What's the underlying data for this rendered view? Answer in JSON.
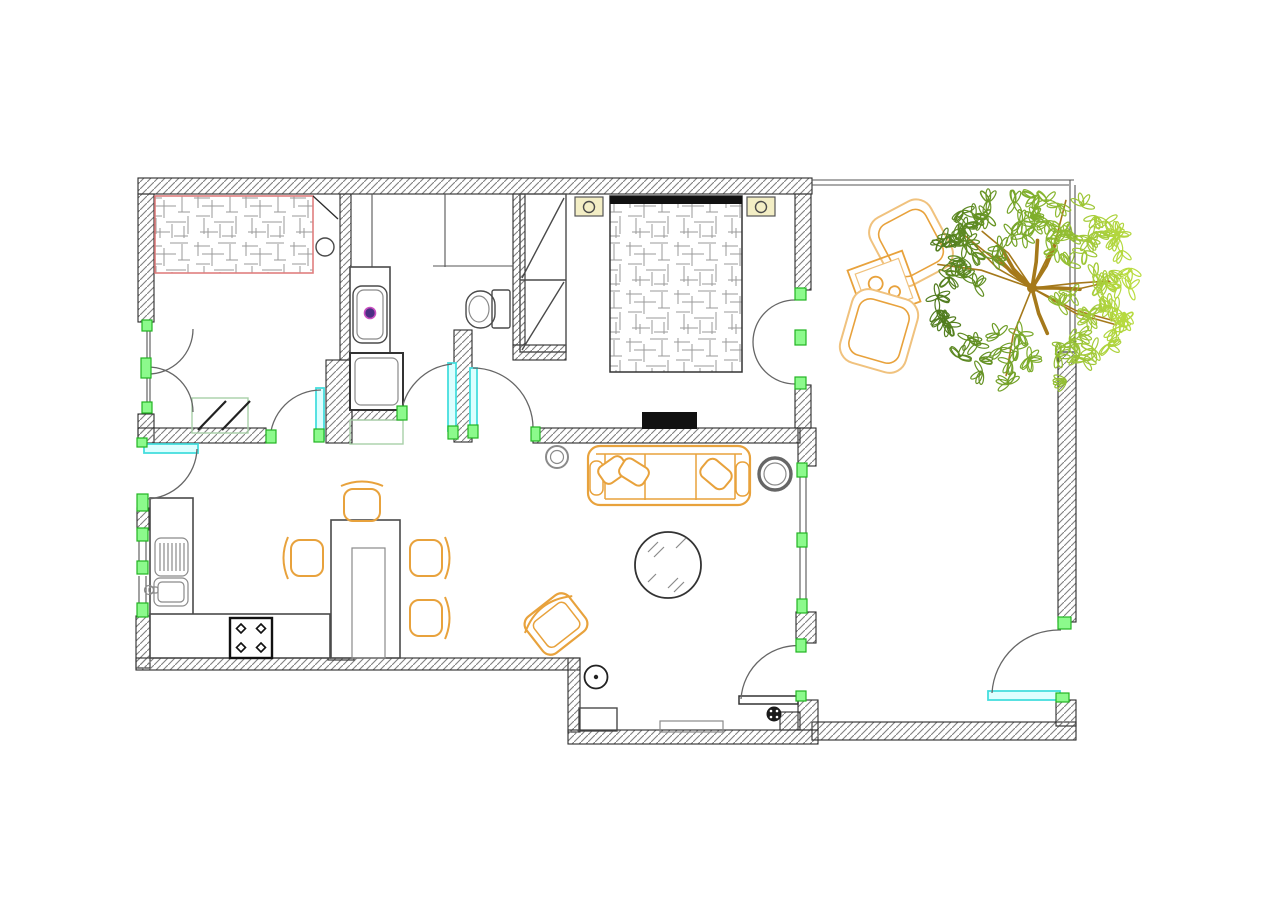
{
  "document": {
    "type": "architectural-floor-plan",
    "title": "Apartment floor plan with terrace and garden tree",
    "background": "#ffffff",
    "visible_text": ""
  },
  "colors": {
    "wall_stroke": "#2b2b2b",
    "wall_hatch": "#808080",
    "furniture": "#4a4a4a",
    "furniture_gray": "#8a8a8a",
    "black": "#111111",
    "orange": "#E8A23C",
    "orange_light": "#F0C27E",
    "marker_green_fill": "#8CFA8C",
    "marker_green_stroke": "#22B422",
    "door_cyan_stroke": "#45DEDE",
    "door_cyan_fill": "#DCFFFF",
    "bed_outline_red": "#E07F7F",
    "bed_hatch": "#9a9a9a",
    "fixture_yellow": "#F3EEC5",
    "drain_purple": "#4B2E83",
    "drain_magenta": "#C94FC0",
    "mat_green": "#A8D0A8",
    "tree_branch": "#A5791B",
    "leaf_dark": "#4F7A1E",
    "leaf_mid": "#7FAE2C",
    "leaf_light": "#B9DC40"
  },
  "rooms": [
    {
      "name": "second-bedroom",
      "position": "top-left",
      "furniture": [
        "double-bed-red-outline",
        "round-stool",
        "floor-mat",
        "double-entry-doors"
      ]
    },
    {
      "name": "laundry-niche",
      "position": "top-center-left",
      "furniture": [
        "washbasin-with-drain",
        "washing-machine",
        "shelf-mat",
        "service-shaft"
      ]
    },
    {
      "name": "bathroom",
      "position": "top-center",
      "furniture": [
        "shower-partition",
        "toilet"
      ]
    },
    {
      "name": "master-bedroom",
      "position": "top-right-of-center",
      "furniture": [
        "double-bed",
        "headboard",
        "nightstand-left",
        "nightstand-right",
        "built-in-wardrobe",
        "tv",
        "french-doors-to-terrace"
      ]
    },
    {
      "name": "kitchen",
      "position": "bottom-left",
      "furniture": [
        "counter-l-shape",
        "sink-basin",
        "drainboard",
        "faucet",
        "cooktop-4-burner"
      ]
    },
    {
      "name": "dining-area",
      "position": "bottom-center-left",
      "furniture": [
        "dining-table",
        "chair-north",
        "chair-west",
        "chair-east-upper",
        "chair-east-lower"
      ]
    },
    {
      "name": "living-room",
      "position": "bottom-center",
      "furniture": [
        "sofa-three-seat",
        "throw-pillows",
        "planter-small",
        "planter-large",
        "round-glass-coffee-table",
        "armchair",
        "floor-lamp",
        "glazed-wall"
      ]
    },
    {
      "name": "entry-hall",
      "position": "bottom",
      "furniture": [
        "floor-lamp",
        "shoe-cabinet",
        "doormat",
        "entrance-door",
        "floor-drain"
      ]
    },
    {
      "name": "terrace-garden",
      "position": "right",
      "furniture": [
        "outdoor-armchair-upper",
        "outdoor-side-table-two-cups",
        "outdoor-armchair-lower",
        "garden-tree",
        "garden-gate"
      ]
    }
  ],
  "symbols": {
    "hatched_fill": "structural-wall",
    "thin_double_line": "window-glazing-or-fence",
    "green_rectangle": "opening-frame-marker",
    "cyan_rectangle": "door-leaf",
    "quarter_arc": "door-swing",
    "crosshatch_fill": "bed-mattress",
    "dotted_fill": "upholstered-seat"
  },
  "counts": {
    "dining_chairs": 4,
    "outdoor_armchairs": 2,
    "beds": 2,
    "nightstands": 2,
    "planters": 2,
    "door_swings": 9
  },
  "tree": {
    "cx": 1032,
    "cy": 288,
    "radius": 96,
    "branches": 16,
    "leaves": 96,
    "leaf_colors": [
      "#4F7A1E",
      "#7FAE2C",
      "#B9DC40"
    ],
    "branch_color": "#A5791B"
  }
}
